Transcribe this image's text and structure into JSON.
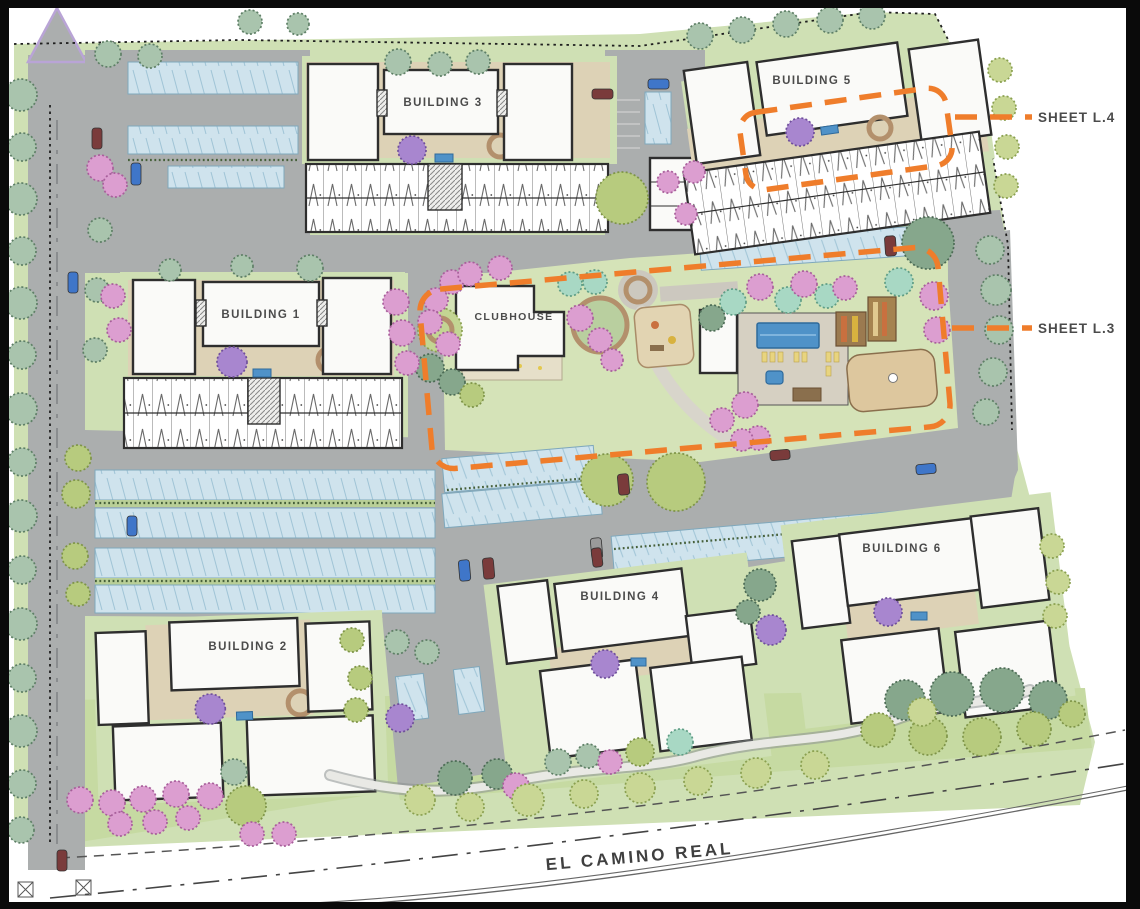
{
  "labels": {
    "building1": "BUILDING 1",
    "building2": "BUILDING 2",
    "building3": "BUILDING 3",
    "building4": "BUILDING 4",
    "building5": "BUILDING 5",
    "building6": "BUILDING 6",
    "clubhouse": "CLUBHOUSE",
    "street": "EL CAMINO REAL"
  },
  "callouts": {
    "sheet_l4": "SHEET L.4",
    "sheet_l3": "SHEET L.3"
  },
  "colors": {
    "callout_orange": "#ef7d2b",
    "road_gray": "#abaeae",
    "canopy_blue": "#cfe3ed",
    "pool_blue": "#4f92c8",
    "landscape_green": "#cfe0b4",
    "tree_pink": "#dc9ed0",
    "tree_purple": "#a886cf",
    "building_fill": "#fafaf8",
    "line_dark": "#2e2e2e",
    "label_text": "#4b4b4b"
  }
}
